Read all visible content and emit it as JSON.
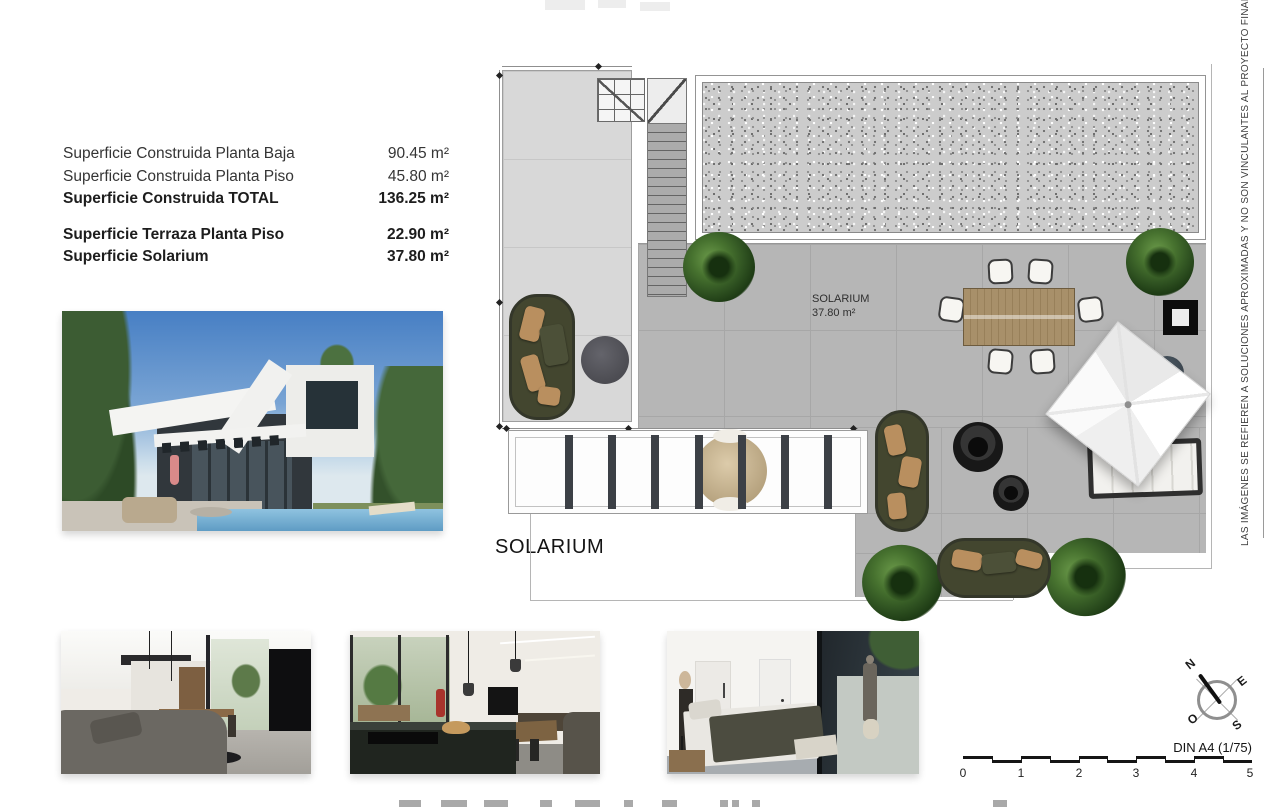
{
  "surface_table": {
    "rows": [
      {
        "label": "Superficie Construida Planta Baja",
        "value": "90.45 m²"
      },
      {
        "label": "Superficie Construida Planta Piso",
        "value": "45.80 m²"
      },
      {
        "label": "Superficie Construida TOTAL",
        "value": "136.25 m²"
      },
      {
        "label": "Superficie Terraza Planta Piso",
        "value": "22.90 m²"
      },
      {
        "label": "Superficie Solarium",
        "value": "37.80 m²"
      }
    ]
  },
  "solarium_heading": "SOLARIUM",
  "plan": {
    "room_label_name": "SOLARIUM",
    "room_label_area": "37.80 m²"
  },
  "disclaimer": "LAS IMÁGENES SE REFIEREN A SOLUCIONES APROXIMADAS Y NO SON VINCULANTES AL PROYECTO FINAL",
  "compass": {
    "north": "N",
    "east": "E",
    "south": "S",
    "west": "O"
  },
  "scale_bar": {
    "label": "DIN A4 (1/75)",
    "ticks": [
      "0",
      "1",
      "2",
      "3",
      "4",
      "5"
    ]
  },
  "colors": {
    "plan_gray": "#b6b6b6",
    "plan_light": "#d8d8d8",
    "sofa_olive": "#43462f",
    "wood": "#a8906a"
  }
}
